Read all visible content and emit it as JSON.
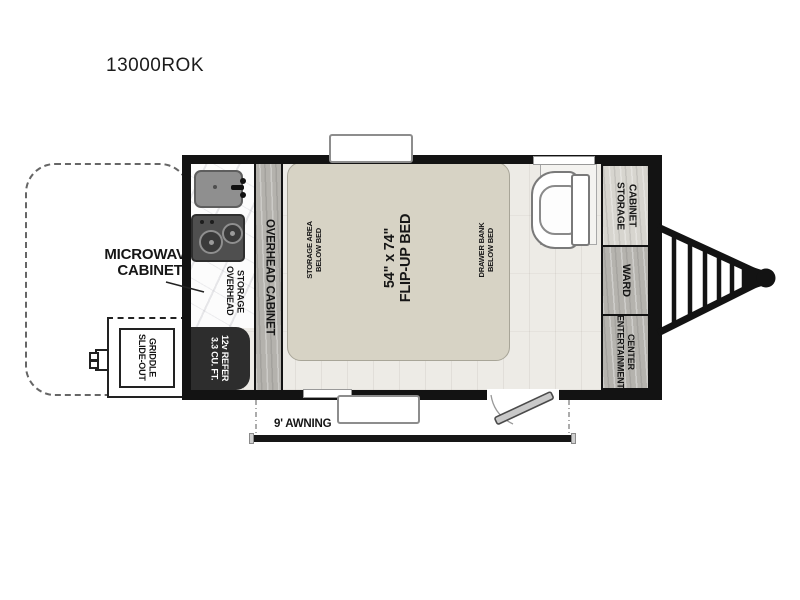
{
  "page": {
    "title": "13000ROK"
  },
  "labels": {
    "microwave_cabinet": "MICROWAVE\nCABINET",
    "slide_out_griddle": "SLIDE-OUT\nGRIDDLE",
    "overhead_storage": "OVERHEAD\nSTORAGE",
    "overhead_cabinet": "OVERHEAD CABINET",
    "refer": "3.3 CU. FT.\n12v REFER",
    "bed": "54\" x 74\"\nFLIP-UP BED",
    "storage_area_below_bed": "STORAGE AREA\nBELOW BED",
    "drawer_bank_below_bed": "DRAWER BANK\nBELOW BED",
    "storage_cabinet": "STORAGE\nCABINET",
    "ward": "WARD",
    "entertainment_center": "ENTERTAINMENT\nCENTER",
    "awning": "9' AWNING"
  },
  "colors": {
    "wall": "#131313",
    "floor": "#edebe6",
    "bed_fill": "#d7d3c5",
    "refer_fill": "#2d2d2d",
    "wood_gray": "#b4b2ad",
    "wood_light": "#d7d5cf",
    "door_fill": "#c9c9c9"
  }
}
